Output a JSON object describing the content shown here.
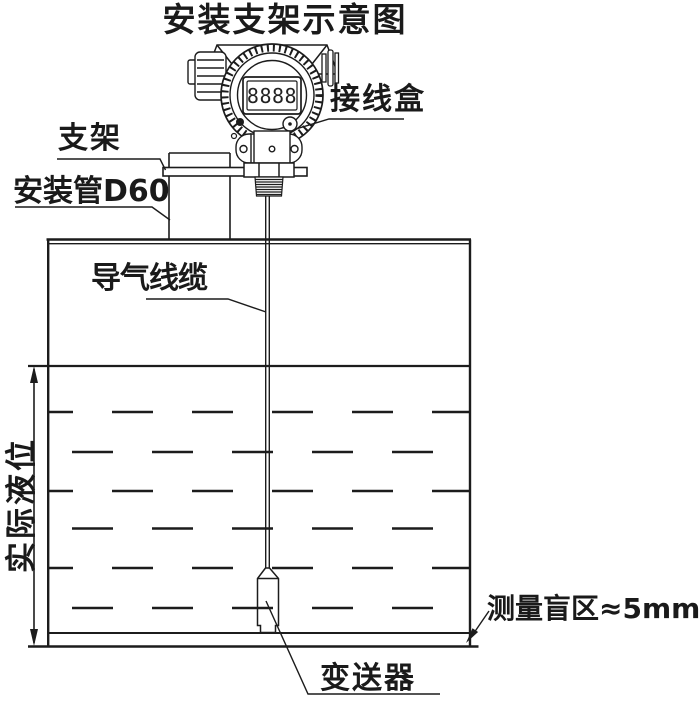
{
  "title": "安装支架示意图",
  "labels": {
    "junction_box": "接线盒",
    "bracket": "支架",
    "mounting_pipe": "安装管D60",
    "air_cable": "导气线缆",
    "actual_level": "实际液位",
    "blind_zone": "测量盲区≈5mm",
    "transmitter": "变送器"
  },
  "display": {
    "value": "8888"
  },
  "colors": {
    "line": "#1c1c1c",
    "background": "#ffffff"
  }
}
